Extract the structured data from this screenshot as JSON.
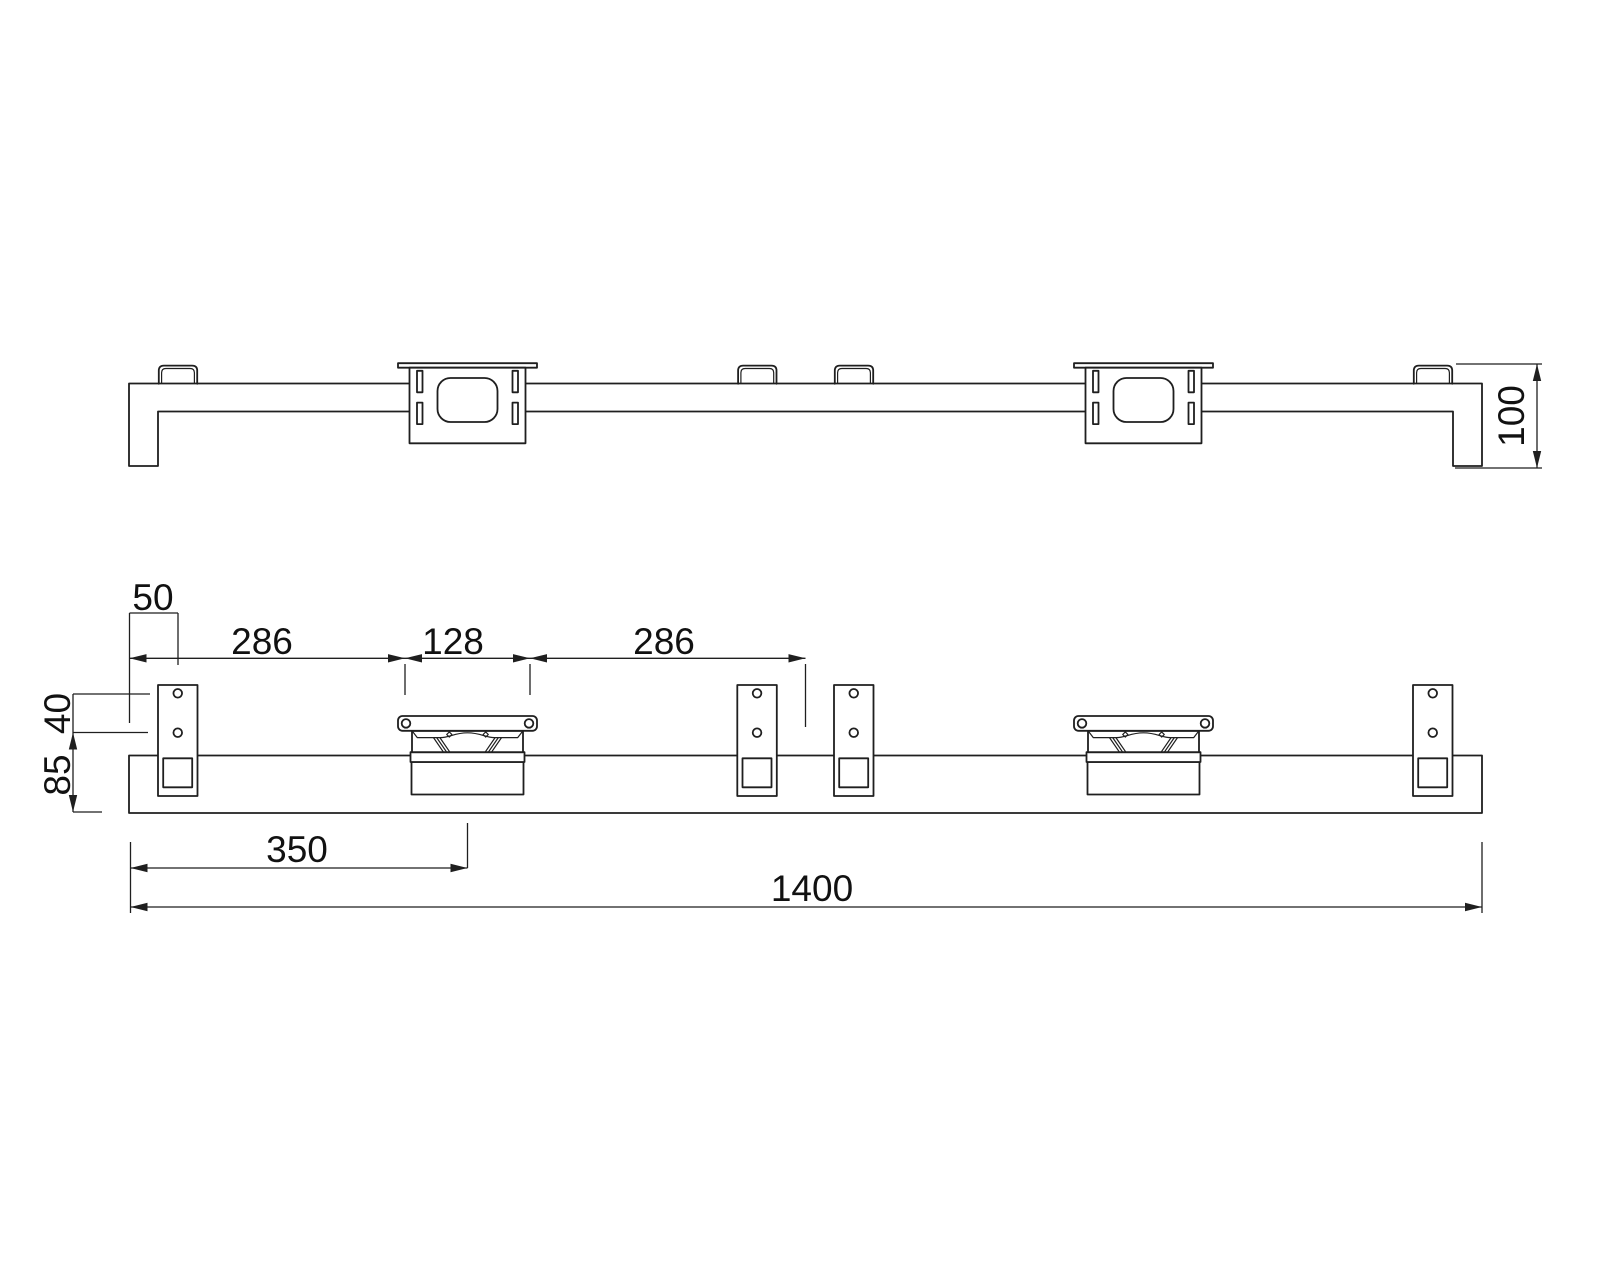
{
  "drawing": {
    "type": "engineering-drawing",
    "views": {
      "top_view": {
        "label": "top-view"
      },
      "front_view": {
        "label": "front-view"
      }
    }
  },
  "colors": {
    "line": "#1f1f1f",
    "text": "#111111",
    "background": "#ffffff"
  },
  "top_view": {
    "dims": {
      "end_height": "100"
    }
  },
  "front_view": {
    "dims": {
      "tab_offset": "50",
      "span_left": "286",
      "bracket_hole_spacing": "128",
      "span_right": "286",
      "tab_hole_spacing": "40",
      "hole_to_bottom": "85",
      "bracket_center": "350",
      "overall_length": "1400"
    }
  }
}
